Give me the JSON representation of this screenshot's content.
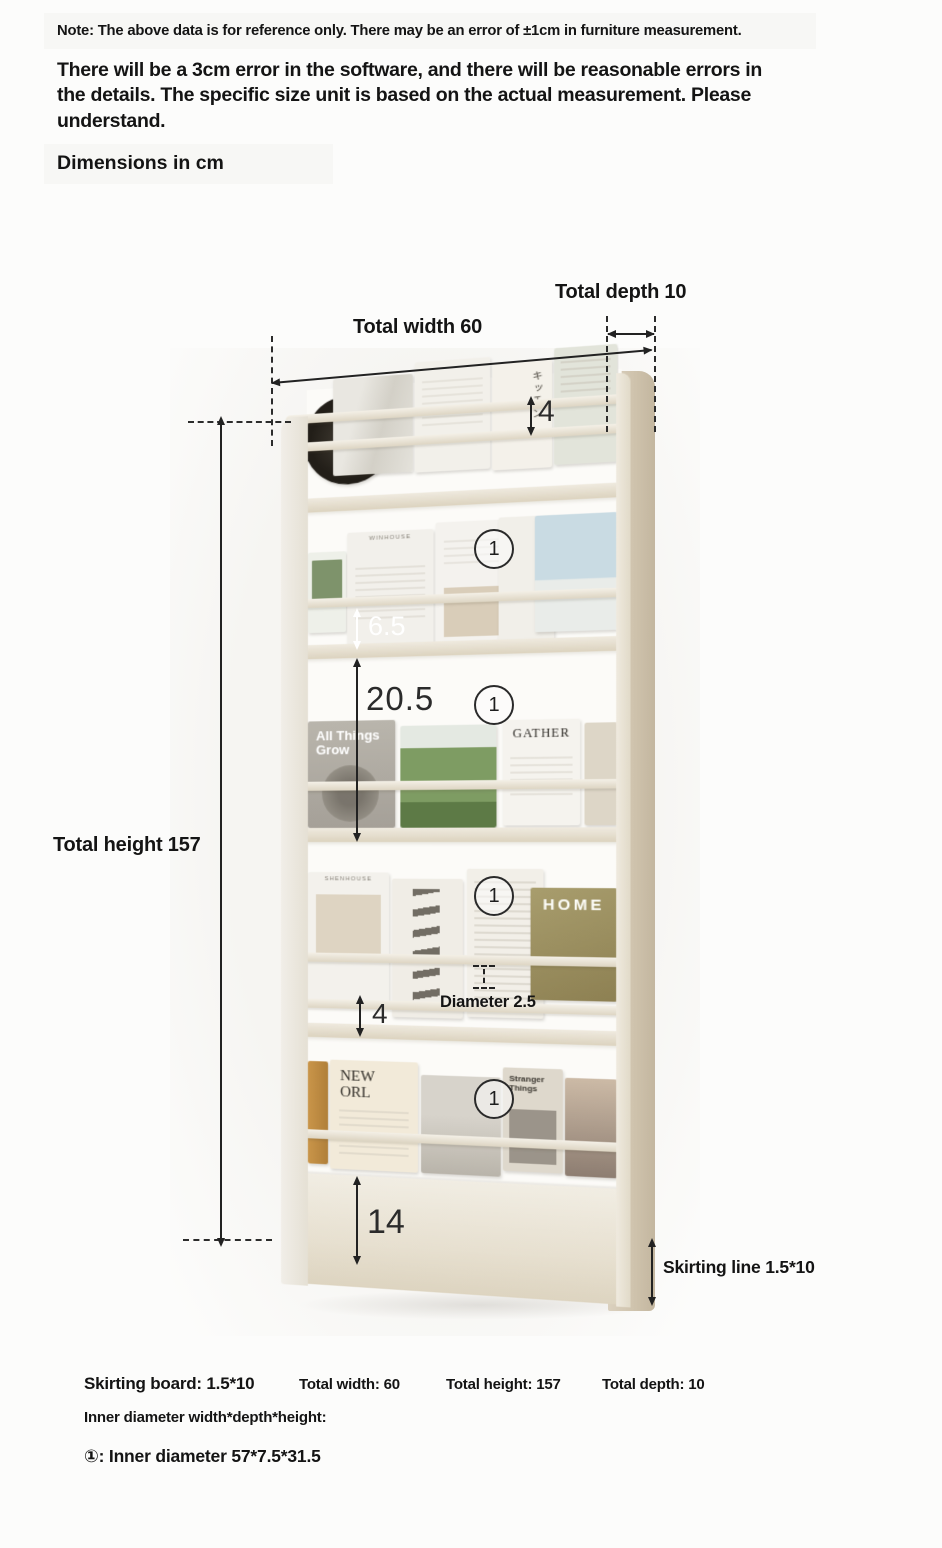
{
  "header": {
    "note": "Note: The above data is for reference only. There may be an error of ±1cm in furniture measurement.",
    "paragraph": "There will be a 3cm error in the software, and there will be reasonable errors in the details. The specific size unit is based on the actual measurement. Please understand.",
    "dimensions_title": "Dimensions in cm"
  },
  "diagram": {
    "marker": "1",
    "labels": {
      "total_depth": "Total depth 10",
      "total_width": "Total width 60",
      "total_height": "Total height 157",
      "skirting_line": "Skirting line 1.5*10",
      "diameter": "Diameter 2.5"
    },
    "dims": {
      "top_rail_gap": "4",
      "rail_to_shelf_gap": "6.5",
      "opening_height": "20.5",
      "mid_rail_gap": "4",
      "skirt_height": "14"
    },
    "shelf_titles": {
      "tier1_jp": "キッチン",
      "tier2_brand": "WINHOUSE",
      "tier3_line1": "All Things",
      "tier3_line2": "Grow",
      "tier3_gather": "GATHER",
      "tier4_brand": "SHENHOUSE",
      "tier4_home": "HOME",
      "tier5_new_line1": "NEW",
      "tier5_new_line2": "ORL",
      "tier5_stranger": "Stranger Things"
    }
  },
  "footer": {
    "skirting_board": "Skirting board: 1.5*10",
    "total_width": "Total width: 60",
    "total_height": "Total height: 157",
    "total_depth": "Total depth: 10",
    "inner_diameter_label": "Inner diameter width*depth*height:",
    "inner_diameter_value": "①: Inner diameter 57*7.5*31.5"
  },
  "colors": {
    "annotation_line": "#222222",
    "shelf_cream": "#e9e3d6",
    "side_panel_tan": "#cfc3ad",
    "photo_background": "#f6f5f2"
  }
}
